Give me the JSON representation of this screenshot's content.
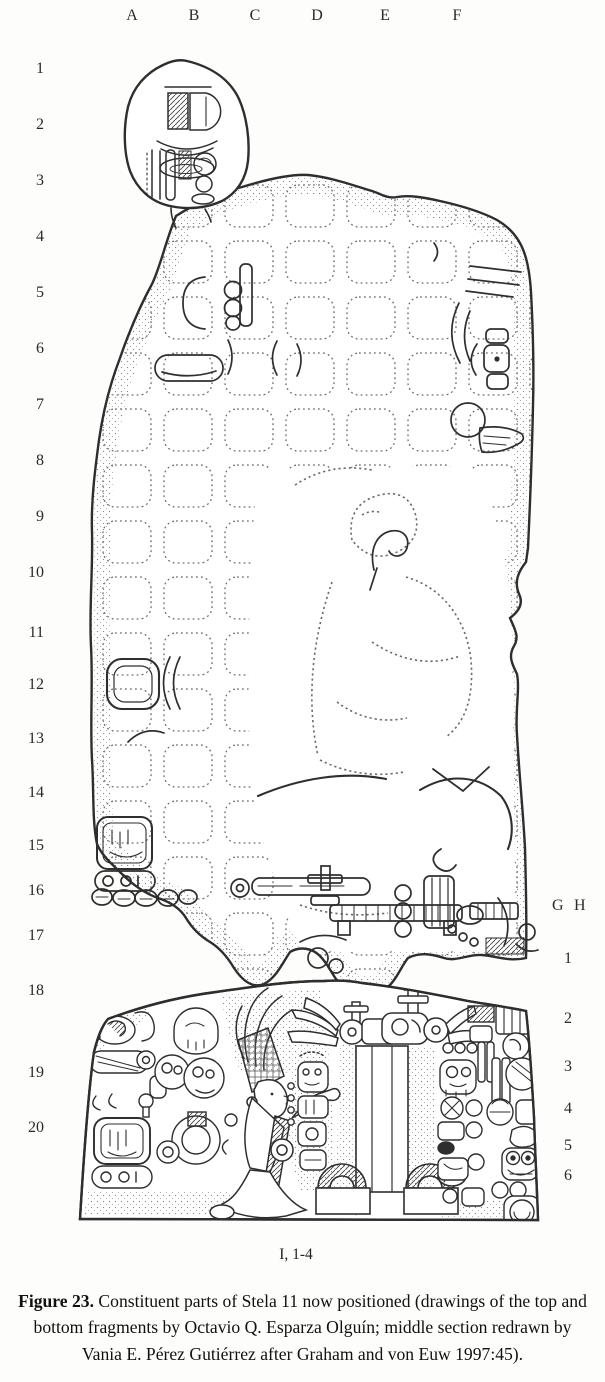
{
  "grid": {
    "top_columns": [
      "A",
      "B",
      "C",
      "D",
      "E",
      "F"
    ],
    "left_rows": [
      "1",
      "2",
      "3",
      "4",
      "5",
      "6",
      "7",
      "8",
      "9",
      "10",
      "11",
      "12",
      "13",
      "14",
      "15",
      "16",
      "17",
      "18",
      "19",
      "20"
    ],
    "right_columns": [
      "G",
      "H"
    ],
    "right_rows": [
      "1",
      "2",
      "3",
      "4",
      "5",
      "6"
    ],
    "bottom_label": "I, 1-4"
  },
  "caption": {
    "label": "Figure 23.",
    "text": " Constituent parts of Stela 11 now positioned (drawings of the top and bottom fragments by Octavio Q. Esparza Olguín; middle section redrawn by Vania E. Pérez Gutiérrez after Graham and von Euw 1997:45)."
  },
  "colors": {
    "ink": "#2e2e2e",
    "paper": "#fdfdfb",
    "dotted": "#6a6a6a"
  }
}
